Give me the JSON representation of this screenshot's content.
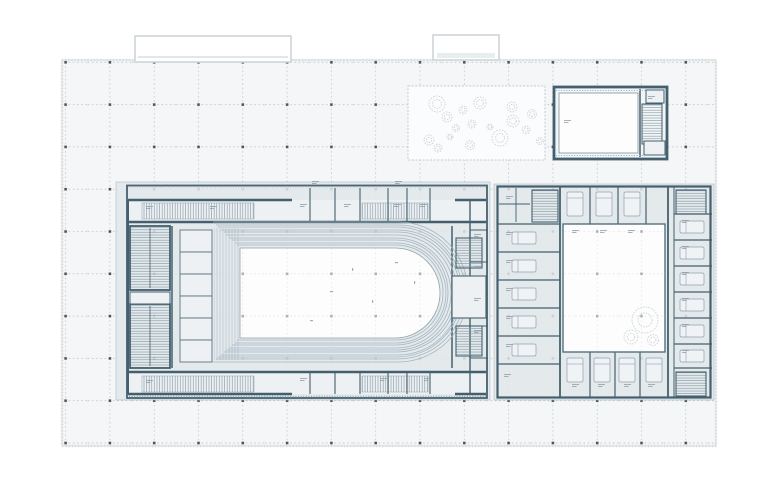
{
  "drawing": {
    "kind": "architectural-floor-plan",
    "zones": {
      "plaza": "Paved plaza with structural grid",
      "canopy_west": "West entrance canopy outline",
      "canopy_center": "Center entrance canopy outline",
      "garden": "Planted garden court",
      "annex_hall": "Detached annex hall with stair",
      "theater": "Theater block",
      "foyer_north": "North foyer corridor",
      "foyer_south": "South foyer corridor",
      "stair_core": "Stair core",
      "stage_platforms": "Stage-side platform lifts",
      "seating": "Auditorium seating rows",
      "arena": "Arena / auditorium floor",
      "backstage": "Backstage rooms",
      "courtyard_building": "Courtyard service building",
      "courtyard": "Open courtyard",
      "rooms_wing": "East wing of small rooms",
      "room_labels": "Fine-print room labels (illegible at this scale)"
    },
    "grid": {
      "columns": 15,
      "rows": 10,
      "spacing_x": 44.3,
      "spacing_y": 42.3
    },
    "counts": {
      "garden_trees": 17,
      "courtyard_trees": 3,
      "seating_row_lines": 10,
      "east_wing_rooms": 8
    }
  },
  "colors": {
    "page": "#ffffff",
    "plaza": "#f4f6f7",
    "plaza_border": "#c9ced2",
    "grid_line": "#b7bdc2",
    "grid_marker": "#4a555c",
    "building_fill": "#e4e9ec",
    "corridor_fill": "#eef1f3",
    "wall": "#44606e",
    "wall_light": "#7d93a0",
    "seat_row": "#a4b6c0",
    "arena": "#fdfdfd",
    "courtyard": "#fdfdfd",
    "tree": "#ccd3d8",
    "hatch": "#7f95a1",
    "label_mark": "#8d9ba4",
    "canopy": "#cfd5d9",
    "garden_fill": "#fbfcfd",
    "garden_border": "#c2cad0"
  }
}
